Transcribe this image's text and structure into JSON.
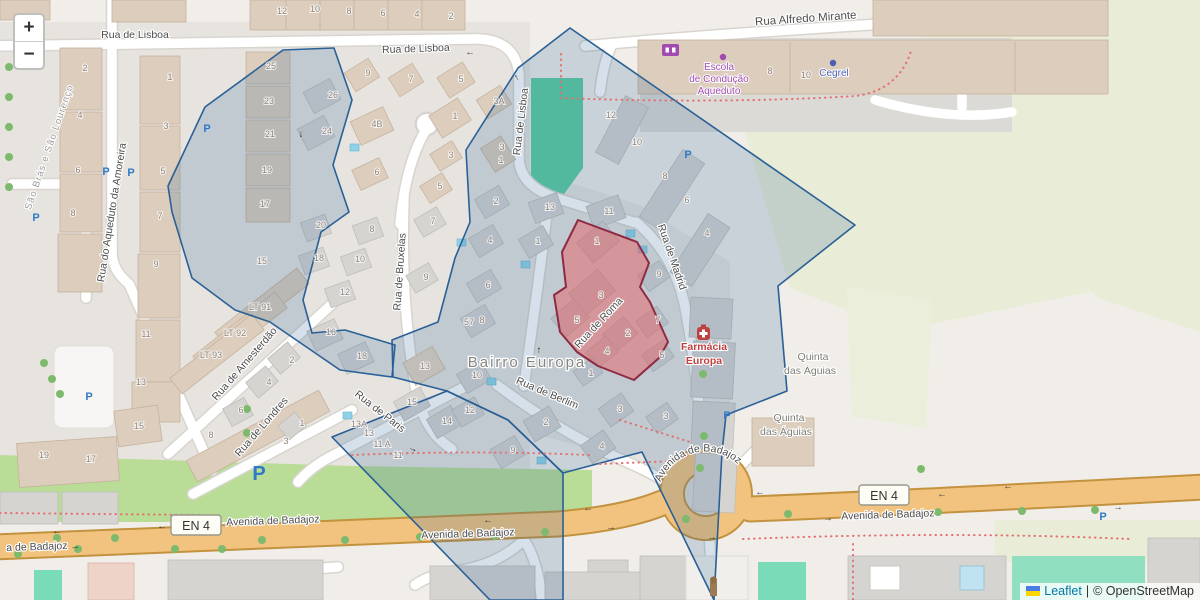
{
  "map": {
    "controls": {
      "zoom_in": "+",
      "zoom_out": "−"
    },
    "attribution": {
      "leaflet": "Leaflet",
      "divider": "|",
      "osm": "© OpenStreetMap"
    },
    "colors": {
      "overlay_blue_stroke": "#2a6096",
      "overlay_red_stroke": "#8e2a44",
      "primary_road": "#f2c37e",
      "park_green": "#5ccfa0",
      "pitch_green": "#7adbb8",
      "scrub": "#e9ecd6",
      "grass": "#b9dc97",
      "pool_blue": "#8fd2e8",
      "parking_blue": "#2e7ac7",
      "school_purple": "#a14bb0",
      "pharmacy_red": "#bf4040"
    },
    "street_labels": [
      {
        "t": "Rua de Lisboa",
        "x": 135,
        "y": 38,
        "r": 0
      },
      {
        "t": "Rua de Lisboa",
        "x": 416,
        "y": 52,
        "r": -2
      },
      {
        "t": "Rua de Lisboa",
        "x": 524,
        "y": 122,
        "r": -83
      },
      {
        "t": "Rua Alfredo Mirante",
        "x": 806,
        "y": 22,
        "r": -4,
        "s": 11.5
      },
      {
        "t": "Rua do Aqueduto da Amoreira",
        "x": 115,
        "y": 213,
        "r": -81
      },
      {
        "t": "Rua de Bruxelas",
        "x": 403,
        "y": 272,
        "r": -86
      },
      {
        "t": "Rua de Amesterdão",
        "x": 247,
        "y": 366,
        "r": -49
      },
      {
        "t": "Rua de Londres",
        "x": 264,
        "y": 429,
        "r": -49
      },
      {
        "t": "Rua de Paris",
        "x": 378,
        "y": 414,
        "r": 38
      },
      {
        "t": "Rua de Berlim",
        "x": 546,
        "y": 396,
        "r": 23
      },
      {
        "t": "Rua de Roma",
        "x": 601,
        "y": 325,
        "r": -47
      },
      {
        "t": "Rua de Madrid",
        "x": 669,
        "y": 258,
        "r": 71
      },
      {
        "t": "Avenida de Badajoz",
        "x": 273,
        "y": 524,
        "r": -2
      },
      {
        "t": "Avenida de Badajoz",
        "x": 468,
        "y": 537,
        "r": -2
      },
      {
        "t": "Avenida de Badajoz",
        "x": 888,
        "y": 518,
        "r": -2
      },
      {
        "t": "a de Badajoz",
        "x": 37,
        "y": 550,
        "r": -2
      }
    ],
    "roundabout_label": {
      "t": "Avenida de Badajoz"
    },
    "area_labels": [
      {
        "t": "São Brás e São Lourenço",
        "x": 52,
        "y": 148,
        "r": -71,
        "cls": "boundary"
      },
      {
        "t": "Bairro Europa",
        "x": 527,
        "y": 367,
        "r": 0,
        "cls": "hamlet"
      },
      {
        "t": "Quinta",
        "x": 813,
        "y": 360,
        "r": 0,
        "cls": "place"
      },
      {
        "t": "das Águias",
        "x": 810,
        "y": 374,
        "r": 0,
        "cls": "place"
      },
      {
        "t": "Quinta",
        "x": 789,
        "y": 421,
        "r": 0,
        "cls": "place"
      },
      {
        "t": "das Águias",
        "x": 786,
        "y": 435,
        "r": 0,
        "cls": "place"
      }
    ],
    "poi_labels": [
      {
        "t": "Escola",
        "x": 719,
        "y": 70,
        "cls": "poi-school"
      },
      {
        "t": "de Condução",
        "x": 719,
        "y": 82,
        "cls": "poi-school"
      },
      {
        "t": "Aqueduto",
        "x": 719,
        "y": 94,
        "cls": "poi-school"
      },
      {
        "t": "Cegrel",
        "x": 834,
        "y": 76,
        "cls": "poi-shop"
      },
      {
        "t": "Farmácia",
        "x": 704,
        "y": 350,
        "cls": "poi-pharm"
      },
      {
        "t": "Europa",
        "x": 704,
        "y": 364,
        "cls": "poi-pharm"
      }
    ],
    "road_refs": [
      {
        "t": "EN 4",
        "x": 196,
        "y": 526
      },
      {
        "t": "EN 4",
        "x": 884,
        "y": 496
      }
    ],
    "house_numbers": [
      {
        "t": "12",
        "x": 282,
        "y": 14
      },
      {
        "t": "10",
        "x": 315,
        "y": 12
      },
      {
        "t": "8",
        "x": 349,
        "y": 14
      },
      {
        "t": "6",
        "x": 383,
        "y": 16
      },
      {
        "t": "4",
        "x": 417,
        "y": 17
      },
      {
        "t": "2",
        "x": 451,
        "y": 19
      },
      {
        "t": "2",
        "x": 85,
        "y": 71
      },
      {
        "t": "4",
        "x": 80,
        "y": 118
      },
      {
        "t": "6",
        "x": 78,
        "y": 173
      },
      {
        "t": "8",
        "x": 73,
        "y": 216
      },
      {
        "t": "1",
        "x": 170,
        "y": 80
      },
      {
        "t": "3",
        "x": 166,
        "y": 129
      },
      {
        "t": "5",
        "x": 163,
        "y": 174
      },
      {
        "t": "7",
        "x": 160,
        "y": 219
      },
      {
        "t": "9",
        "x": 156,
        "y": 267
      },
      {
        "t": "11",
        "x": 146,
        "y": 337
      },
      {
        "t": "13",
        "x": 141,
        "y": 385
      },
      {
        "t": "25",
        "x": 271,
        "y": 69
      },
      {
        "t": "23",
        "x": 269,
        "y": 104
      },
      {
        "t": "21",
        "x": 270,
        "y": 137
      },
      {
        "t": "19",
        "x": 267,
        "y": 173
      },
      {
        "t": "17",
        "x": 265,
        "y": 207
      },
      {
        "t": "26",
        "x": 333,
        "y": 98
      },
      {
        "t": "24",
        "x": 327,
        "y": 134
      },
      {
        "t": "4B",
        "x": 377,
        "y": 127
      },
      {
        "t": "6",
        "x": 377,
        "y": 175
      },
      {
        "t": "9",
        "x": 368,
        "y": 76
      },
      {
        "t": "7",
        "x": 411,
        "y": 82
      },
      {
        "t": "5",
        "x": 461,
        "y": 82
      },
      {
        "t": "1",
        "x": 455,
        "y": 119
      },
      {
        "t": "3A",
        "x": 499,
        "y": 104
      },
      {
        "t": "3",
        "x": 451,
        "y": 158
      },
      {
        "t": "3",
        "x": 502,
        "y": 150
      },
      {
        "t": "1",
        "x": 501,
        "y": 163
      },
      {
        "t": "5",
        "x": 440,
        "y": 189
      },
      {
        "t": "2",
        "x": 496,
        "y": 204
      },
      {
        "t": "20",
        "x": 321,
        "y": 228
      },
      {
        "t": "18",
        "x": 319,
        "y": 261
      },
      {
        "t": "12",
        "x": 345,
        "y": 295
      },
      {
        "t": "10",
        "x": 360,
        "y": 262
      },
      {
        "t": "8",
        "x": 372,
        "y": 232
      },
      {
        "t": "16",
        "x": 331,
        "y": 335
      },
      {
        "t": "18",
        "x": 362,
        "y": 359
      },
      {
        "t": "15",
        "x": 262,
        "y": 264
      },
      {
        "t": "7",
        "x": 433,
        "y": 224
      },
      {
        "t": "9",
        "x": 426,
        "y": 280
      },
      {
        "t": "4",
        "x": 490,
        "y": 243
      },
      {
        "t": "6",
        "x": 488,
        "y": 288
      },
      {
        "t": "8",
        "x": 482,
        "y": 323
      },
      {
        "t": "57",
        "x": 469,
        "y": 325
      },
      {
        "t": "10",
        "x": 477,
        "y": 378
      },
      {
        "t": "13",
        "x": 425,
        "y": 369
      },
      {
        "t": "15",
        "x": 412,
        "y": 405
      },
      {
        "t": "14",
        "x": 447,
        "y": 424
      },
      {
        "t": "12",
        "x": 470,
        "y": 413
      },
      {
        "t": "13",
        "x": 550,
        "y": 210
      },
      {
        "t": "11",
        "x": 609,
        "y": 214
      },
      {
        "t": "1",
        "x": 538,
        "y": 244
      },
      {
        "t": "12",
        "x": 611,
        "y": 118
      },
      {
        "t": "10",
        "x": 637,
        "y": 145
      },
      {
        "t": "1",
        "x": 597,
        "y": 244
      },
      {
        "t": "3",
        "x": 601,
        "y": 298
      },
      {
        "t": "5",
        "x": 577,
        "y": 323
      },
      {
        "t": "2",
        "x": 628,
        "y": 336
      },
      {
        "t": "4",
        "x": 607,
        "y": 354
      },
      {
        "t": "1",
        "x": 591,
        "y": 376
      },
      {
        "t": "8",
        "x": 665,
        "y": 179
      },
      {
        "t": "6",
        "x": 687,
        "y": 203
      },
      {
        "t": "4",
        "x": 707,
        "y": 236
      },
      {
        "t": "9",
        "x": 659,
        "y": 277
      },
      {
        "t": "7",
        "x": 658,
        "y": 323
      },
      {
        "t": "5",
        "x": 662,
        "y": 358
      },
      {
        "t": "3",
        "x": 620,
        "y": 412
      },
      {
        "t": "3",
        "x": 666,
        "y": 419
      },
      {
        "t": "4",
        "x": 602,
        "y": 449
      },
      {
        "t": "2",
        "x": 546,
        "y": 425
      },
      {
        "t": "9",
        "x": 513,
        "y": 453
      },
      {
        "t": "19",
        "x": 44,
        "y": 458
      },
      {
        "t": "17",
        "x": 91,
        "y": 462
      },
      {
        "t": "15",
        "x": 139,
        "y": 429
      },
      {
        "t": "8",
        "x": 211,
        "y": 438
      },
      {
        "t": "6",
        "x": 241,
        "y": 413
      },
      {
        "t": "3",
        "x": 286,
        "y": 444
      },
      {
        "t": "1",
        "x": 302,
        "y": 426
      },
      {
        "t": "13A",
        "x": 359,
        "y": 427
      },
      {
        "t": "13",
        "x": 369,
        "y": 436
      },
      {
        "t": "11 A",
        "x": 382,
        "y": 447
      },
      {
        "t": "11",
        "x": 398,
        "y": 458
      },
      {
        "t": "LT 91",
        "x": 260,
        "y": 310
      },
      {
        "t": "LT 92",
        "x": 235,
        "y": 336
      },
      {
        "t": "LT 93",
        "x": 211,
        "y": 358
      },
      {
        "t": "2",
        "x": 292,
        "y": 363
      },
      {
        "t": "4",
        "x": 269,
        "y": 385
      },
      {
        "t": "8",
        "x": 770,
        "y": 74
      },
      {
        "t": "10",
        "x": 806,
        "y": 78
      }
    ],
    "parking_icons": [
      {
        "x": 207,
        "y": 132
      },
      {
        "x": 106,
        "y": 175
      },
      {
        "x": 131,
        "y": 176
      },
      {
        "x": 36,
        "y": 221
      },
      {
        "x": 89,
        "y": 400
      },
      {
        "x": 688,
        "y": 158
      },
      {
        "x": 727,
        "y": 419
      },
      {
        "x": 1103,
        "y": 520
      },
      {
        "x": 259,
        "y": 480,
        "big": true
      }
    ],
    "poi_dots": [
      {
        "x": 723,
        "y": 57,
        "c": "#a14bb0"
      },
      {
        "x": 833,
        "y": 63,
        "c": "#4a5fb0"
      }
    ],
    "trees": [
      {
        "x": 9,
        "y": 67
      },
      {
        "x": 9,
        "y": 97
      },
      {
        "x": 9,
        "y": 127
      },
      {
        "x": 9,
        "y": 157
      },
      {
        "x": 9,
        "y": 187
      },
      {
        "x": 44,
        "y": 363
      },
      {
        "x": 52,
        "y": 379
      },
      {
        "x": 60,
        "y": 394
      },
      {
        "x": 247,
        "y": 409
      },
      {
        "x": 247,
        "y": 433
      },
      {
        "x": 18,
        "y": 554
      },
      {
        "x": 57,
        "y": 538
      },
      {
        "x": 78,
        "y": 549
      },
      {
        "x": 115,
        "y": 538
      },
      {
        "x": 175,
        "y": 549
      },
      {
        "x": 222,
        "y": 549
      },
      {
        "x": 262,
        "y": 540
      },
      {
        "x": 345,
        "y": 540
      },
      {
        "x": 420,
        "y": 537
      },
      {
        "x": 495,
        "y": 536
      },
      {
        "x": 545,
        "y": 532
      },
      {
        "x": 686,
        "y": 519
      },
      {
        "x": 788,
        "y": 514
      },
      {
        "x": 938,
        "y": 512
      },
      {
        "x": 1022,
        "y": 511
      },
      {
        "x": 1095,
        "y": 510
      },
      {
        "x": 703,
        "y": 374
      },
      {
        "x": 704,
        "y": 436
      },
      {
        "x": 700,
        "y": 468
      },
      {
        "x": 921,
        "y": 469
      }
    ],
    "oneway_arrows": [
      {
        "t": "←",
        "x": 470,
        "y": 55
      },
      {
        "t": "↑",
        "x": 518,
        "y": 80,
        "r": -30
      },
      {
        "t": "↓",
        "x": 301,
        "y": 137
      },
      {
        "t": "↑",
        "x": 539,
        "y": 353
      },
      {
        "t": "→",
        "x": 412,
        "y": 451,
        "r": 25
      },
      {
        "t": "←",
        "x": 57,
        "y": 534
      },
      {
        "t": "→",
        "x": 75,
        "y": 549
      },
      {
        "t": "←",
        "x": 162,
        "y": 529
      },
      {
        "t": "←",
        "x": 488,
        "y": 523
      },
      {
        "t": "←",
        "x": 588,
        "y": 511
      },
      {
        "t": "→",
        "x": 611,
        "y": 530
      },
      {
        "t": "←",
        "x": 760,
        "y": 495
      },
      {
        "t": "→",
        "x": 712,
        "y": 540
      },
      {
        "t": "←",
        "x": 942,
        "y": 497
      },
      {
        "t": "→",
        "x": 1118,
        "y": 510
      },
      {
        "t": "→",
        "x": 828,
        "y": 521
      },
      {
        "t": "←",
        "x": 1008,
        "y": 489
      }
    ],
    "pools": [
      {
        "x": 350,
        "y": 144
      },
      {
        "x": 457,
        "y": 239
      },
      {
        "x": 487,
        "y": 378
      },
      {
        "x": 521,
        "y": 261
      },
      {
        "x": 626,
        "y": 230
      },
      {
        "x": 638,
        "y": 246
      },
      {
        "x": 343,
        "y": 412
      },
      {
        "x": 537,
        "y": 457
      }
    ]
  }
}
